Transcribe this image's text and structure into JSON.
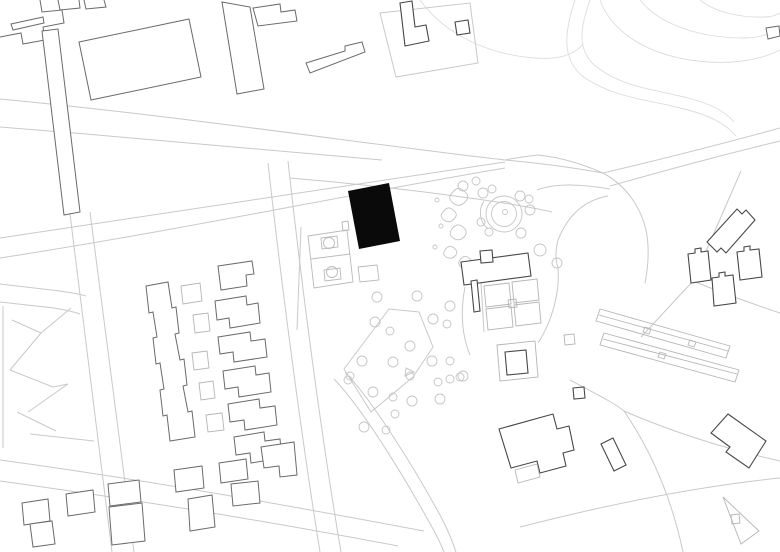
{
  "meta": {
    "title": "Site plan",
    "description": "Black-and-white architectural site plan; context buildings drawn in outline, proposed building filled solid black near plan centre",
    "canvas": {
      "width": 780,
      "height": 552
    }
  },
  "palette": {
    "background": "#ffffff",
    "road_line": "#c9c9c9",
    "faint_line": "#dcdcdc",
    "context_building_line": "#6a6a6a",
    "detail_building_line": "#474747",
    "highlight_building_fill": "#0a0a0a",
    "vegetation_line": "#c5c5c5",
    "court_line": "#b9b9b9",
    "light_structure_line": "#b5b5b5"
  },
  "features": {
    "highlighted_building": "proposed building (solid black rectangle)",
    "basketball_court": "sports court with two keys and centre line",
    "circular_mound": "round landscape feature with concentric rings",
    "orchard": "grove of trees around a five-sided path",
    "garden_plots": "rectangular allotment grid",
    "greenhouses": "two long diagonal glasshouse bars",
    "row_houses": "column of notched row houses",
    "apartment_slab": "long saw-tooth apartment slab",
    "park_paths": "criss-cross park paths in left block",
    "road_network": "curving roads converging at a Y junction"
  }
}
